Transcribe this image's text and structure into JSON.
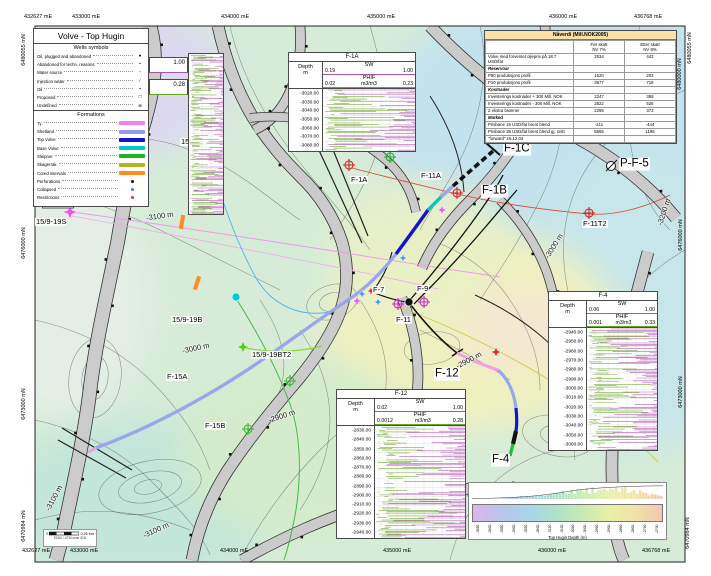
{
  "map": {
    "legend": {
      "title": "Volve - Top Hugin",
      "wells_symbols_title": "Wells symbols",
      "well_symbols": [
        {
          "label": "Oil, plugged and abandoned",
          "glyph": "●"
        },
        {
          "label": "Abandoned for techn. reasons",
          "glyph": "•"
        },
        {
          "label": "Water source",
          "glyph": "▫"
        },
        {
          "label": "Injection water",
          "glyph": "∕"
        },
        {
          "label": "Oil",
          "glyph": "▪"
        },
        {
          "label": "Proposed",
          "glyph": "□"
        },
        {
          "label": "Undefined",
          "glyph": "⊚"
        }
      ],
      "formations_title": "Formations",
      "formations": [
        {
          "label": "Ty",
          "type": "bar",
          "color": "#ee82ee"
        },
        {
          "label": "Shetland",
          "type": "bar",
          "color": "#9898ec"
        },
        {
          "label": "Top Volve",
          "type": "bar",
          "color": "#1414cc"
        },
        {
          "label": "Base Volve",
          "type": "bar",
          "color": "#00c8c8"
        },
        {
          "label": "Sleipner",
          "type": "bar",
          "color": "#1eb41e"
        },
        {
          "label": "Skagerrak",
          "type": "bar",
          "color": "#b4b41e"
        },
        {
          "label": "Cored intervals",
          "type": "bar",
          "color": "#ff8c1e"
        },
        {
          "label": "Perforations",
          "type": "dot",
          "color": "#111111"
        },
        {
          "label": "Collapsed",
          "type": "dot",
          "color": "#3c78f0"
        },
        {
          "label": "Restrictions",
          "type": "dot",
          "color": "#e63232"
        }
      ]
    },
    "minmax_boxes": {
      "sw": "1.00",
      "phif": "0.28"
    },
    "nav_table": {
      "title": "Nåverdi (Mill.NOK2005)",
      "col1_line1": "Før skatt",
      "col1_line2": "NV 7%",
      "col2_line1": "Etter skatt",
      "col2_line2": "NV 8%",
      "rows": [
        {
          "label": "Volve med forventet oljepris på 18.7 USD/fat",
          "v1": "2534",
          "v2": "443",
          "type": "data"
        },
        {
          "label": "Reservoar",
          "v1": "",
          "v2": "",
          "type": "section"
        },
        {
          "label": "P90 produksjons profil",
          "v1": "1520",
          "v2": "203",
          "type": "data"
        },
        {
          "label": "P10 produksjons profil",
          "v1": "3677",
          "v2": "718",
          "type": "data"
        },
        {
          "label": "Kostnader",
          "v1": "",
          "v2": "",
          "type": "section"
        },
        {
          "label": "Investerings kostnader + 300 Mill. NOK",
          "v1": "2247",
          "v2": "359",
          "type": "data"
        },
        {
          "label": "Investerings kostnader - 300 Mill. NOK",
          "v1": "2822",
          "v2": "526",
          "type": "data"
        },
        {
          "label": "2 ekstra brønner",
          "v1": "2295",
          "v2": "373",
          "type": "data"
        },
        {
          "label": "Marked",
          "v1": "",
          "v2": "",
          "type": "section"
        },
        {
          "label": "Prisbane 15 USD/fat brent blend",
          "v1": "-211",
          "v2": "-444",
          "type": "data"
        },
        {
          "label": "Prisbane 35 USD/fat brent blend gj. snitt",
          "v1": "5565",
          "v2": "1196",
          "type": "data"
        },
        {
          "label": "\"forward\" 15.12.04",
          "v1": "",
          "v2": "",
          "type": "data"
        }
      ]
    },
    "log_panels": [
      {
        "id": "F-1A",
        "title": "F-1A",
        "depth_label": "Depth",
        "depth_unit": "m",
        "sw_label": "SW",
        "sw_min": "0.19",
        "sw_max": "1.00",
        "phif_label": "PHIF",
        "phif_min": "0.02",
        "phif_unit": "m3/m3",
        "phif_max": "0.23",
        "depths": [
          "-3020.00",
          "-3030.00",
          "-3040.00",
          "-3050.00",
          "-3060.00",
          "-3070.00",
          "-3080.00"
        ]
      },
      {
        "id": "F-4",
        "title": "F-4",
        "depth_label": "Depth",
        "depth_unit": "m",
        "sw_label": "SW",
        "sw_min": "0.06",
        "sw_max": "1.00",
        "phif_label": "PHIF",
        "phif_min": "0.001",
        "phif_unit": "m3/m3",
        "phif_max": "0.33",
        "depths": [
          "-2940.00",
          "-2950.00",
          "-2960.00",
          "-2970.00",
          "-2980.00",
          "-2990.00",
          "-3000.00",
          "-3010.00",
          "-3020.00",
          "-3030.00",
          "-3040.00",
          "-3050.00",
          "-3060.00"
        ]
      },
      {
        "id": "F-12",
        "title": "F-12",
        "depth_label": "Depth",
        "depth_unit": "m",
        "sw_label": "SW",
        "sw_min": "0.02",
        "sw_max": "1.00",
        "phif_label": "PHIF",
        "phif_min": "0.0012",
        "phif_unit": "m3/m3",
        "phif_max": "0.28",
        "depths": [
          "-2830.00",
          "-2840.00",
          "-2850.00",
          "-2860.00",
          "-2870.00",
          "-2880.00",
          "-2890.00",
          "-2900.00",
          "-2910.00",
          "-2920.00",
          "-2930.00",
          "-2940.00"
        ]
      }
    ],
    "well_labels": [
      {
        "text": "15/9-19S",
        "x": 35,
        "y": 222,
        "big": false
      },
      {
        "text": "15/9-19A",
        "x": 180,
        "y": 142,
        "big": false
      },
      {
        "text": "15/9-19B",
        "x": 171,
        "y": 320,
        "big": false
      },
      {
        "text": "15/9-19BT2",
        "x": 251,
        "y": 355,
        "big": false
      },
      {
        "text": "F-15A",
        "x": 166,
        "y": 377,
        "big": false
      },
      {
        "text": "F-15B",
        "x": 204,
        "y": 426,
        "big": false
      },
      {
        "text": "F-1A",
        "x": 350,
        "y": 180,
        "big": false
      },
      {
        "text": "F-11A",
        "x": 420,
        "y": 176,
        "big": false
      },
      {
        "text": "F-11T2",
        "x": 582,
        "y": 224,
        "big": false
      },
      {
        "text": "F-9",
        "x": 416,
        "y": 289,
        "big": false
      },
      {
        "text": "F-7",
        "x": 372,
        "y": 290,
        "big": false
      },
      {
        "text": "F-11",
        "x": 395,
        "y": 320,
        "big": false
      },
      {
        "text": "F-1C",
        "x": 503,
        "y": 149,
        "big": true
      },
      {
        "text": "F-1B",
        "x": 481,
        "y": 191,
        "big": true
      },
      {
        "text": "P-F-5",
        "x": 619,
        "y": 164,
        "big": true
      },
      {
        "text": "F-12",
        "x": 434,
        "y": 374,
        "big": true
      },
      {
        "text": "F-4",
        "x": 491,
        "y": 460,
        "big": true
      }
    ],
    "contour_labels": [
      {
        "text": "-3100 m",
        "x": 146,
        "y": 216,
        "rot": -8,
        "box": false
      },
      {
        "text": "-3000 m",
        "x": 182,
        "y": 348,
        "rot": -12,
        "box": false
      },
      {
        "text": "-2900 m",
        "x": 455,
        "y": 360,
        "rot": -28,
        "box": false
      },
      {
        "text": "-2900 m",
        "x": 268,
        "y": 416,
        "rot": -18,
        "box": false
      },
      {
        "text": "-3200 m",
        "x": 650,
        "y": 212,
        "rot": -72,
        "box": false
      },
      {
        "text": "-3000 m",
        "x": 540,
        "y": 246,
        "rot": -58,
        "box": false
      },
      {
        "text": "-3100 m",
        "x": 40,
        "y": 498,
        "rot": -62,
        "box": false
      },
      {
        "text": "-3100 m",
        "x": 142,
        "y": 530,
        "rot": -25,
        "box": false
      },
      {
        "text": "-3140.00",
        "x": 42,
        "y": 204,
        "rot": 0,
        "box": true
      }
    ],
    "edge_labels": {
      "top": [
        {
          "text": "432627 mE",
          "x": 24
        },
        {
          "text": "433000 mE",
          "x": 72
        },
        {
          "text": "434000 mE",
          "x": 221
        },
        {
          "text": "435000 mE",
          "x": 367
        },
        {
          "text": "436000 mE",
          "x": 549
        },
        {
          "text": "436768 mE",
          "x": 634
        }
      ],
      "bottom": [
        {
          "text": "432627 mE",
          "x": 22
        },
        {
          "text": "433000 mE",
          "x": 70
        },
        {
          "text": "434000 mE",
          "x": 220
        },
        {
          "text": "435000 mE",
          "x": 383
        },
        {
          "text": "436000 mE",
          "x": 538
        },
        {
          "text": "436768 mE",
          "x": 642
        }
      ],
      "left": [
        {
          "text": "6480055 mN",
          "y": 50
        },
        {
          "text": "6476000 mN",
          "y": 243
        },
        {
          "text": "6473000 mN",
          "y": 404
        },
        {
          "text": "6470984 mN",
          "y": 526
        }
      ],
      "right": [
        {
          "text": "6480055 mN",
          "x": 690,
          "y": 48
        },
        {
          "text": "6480000 mN",
          "x": 680,
          "y": 74
        },
        {
          "text": "6476000 mN",
          "x": 681,
          "y": 235
        },
        {
          "text": "6473000 mN",
          "x": 681,
          "y": 392
        },
        {
          "text": "6470984 mN",
          "x": 688,
          "y": 533
        }
      ]
    },
    "colorbar": {
      "label": "Top Hugin Depth (m)",
      "ticks": [
        "-3450",
        "-3400",
        "-3350",
        "-3300",
        "-3250",
        "-3200",
        "-3150",
        "-3100",
        "-3050",
        "-3000",
        "-2950",
        "-2900",
        "-2850",
        "-2800",
        "-2750",
        "-2700"
      ]
    },
    "scalebar": {
      "zero": "0",
      "dist": "0,25 Km",
      "crs": "ED50 / UTM zone 31N"
    }
  }
}
